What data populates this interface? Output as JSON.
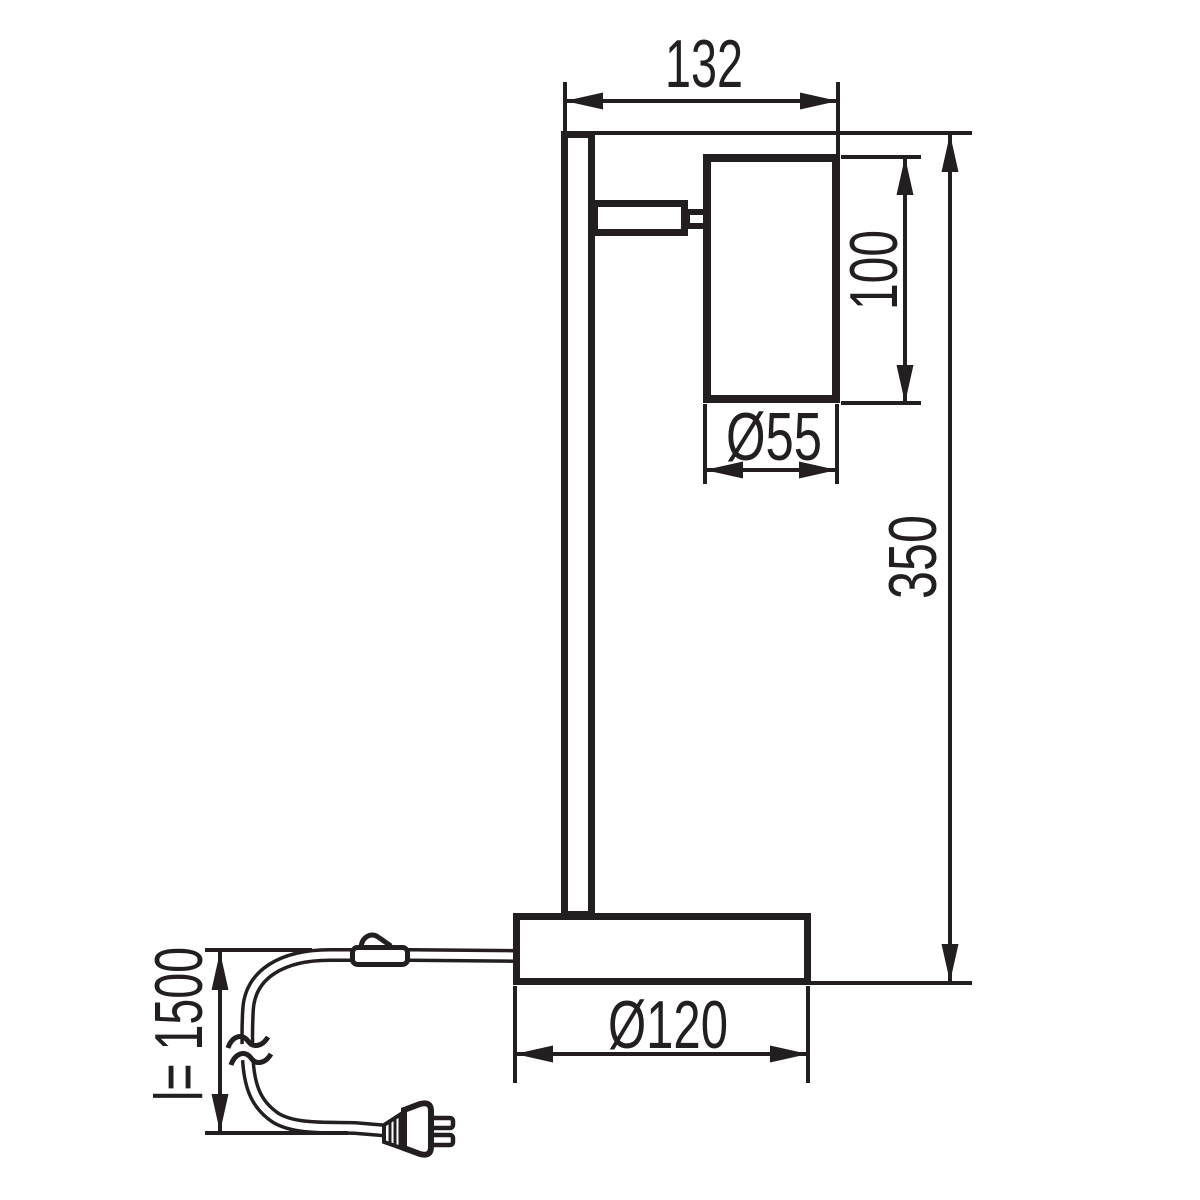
{
  "figure": {
    "kind": "technical dimensional drawing",
    "subject": "table lamp, side elevation",
    "ink_color": "#231f20",
    "background_color": "#ffffff"
  },
  "dimensions": {
    "top_width": {
      "label": "132"
    },
    "shade_height": {
      "label": "100"
    },
    "shade_diameter": {
      "label": "Ø55"
    },
    "total_height": {
      "label": "350"
    },
    "base_diameter": {
      "label": "Ø120"
    },
    "cable_length": {
      "label": "l= 1500"
    }
  }
}
